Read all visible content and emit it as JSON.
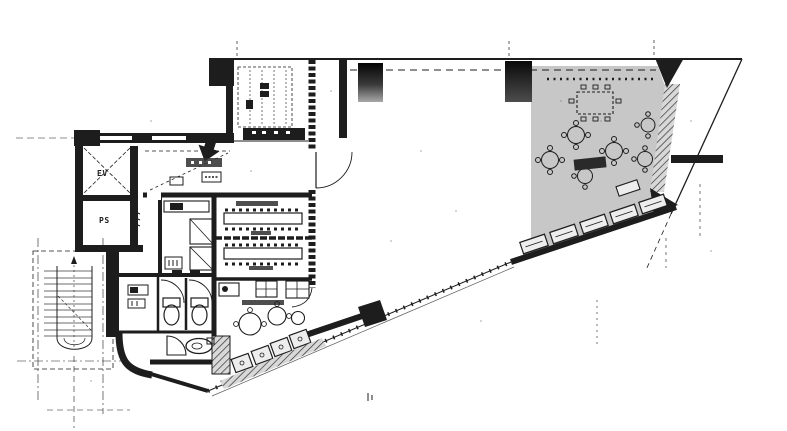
{
  "colors": {
    "paper": "#ffffff",
    "ink": "#1d1d1d",
    "lounge": "#c7c7c7",
    "furniture": "#ededed"
  },
  "labels": {
    "elevator": "EV",
    "pipe_shaft": "PS"
  }
}
